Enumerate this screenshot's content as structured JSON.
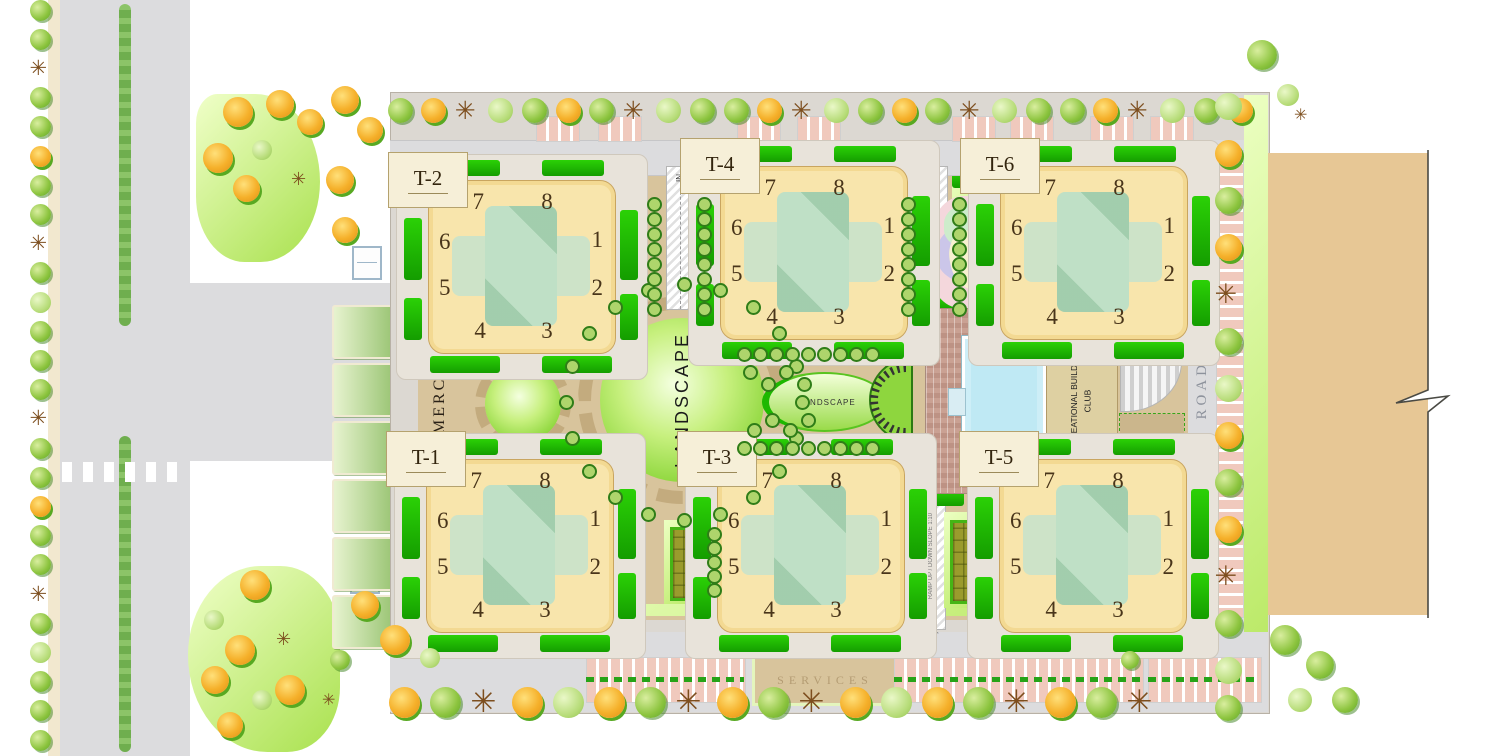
{
  "labels": {
    "road_top": "ROAD",
    "road_right": "ROAD",
    "commercial": "COMMERCIAL",
    "landscape_main": "LANDSCAPE",
    "landscape_small": "LANDSCAPE",
    "recreational_line1": "RECREATIONAL BUILDING /",
    "recreational_line2": "CLUB",
    "services": "SERVICES",
    "in_north_west": "IN",
    "in_north_east": "IN",
    "out_south": "OUT",
    "ramp_note": "RAMP UP / DOWN SLOPE 1:10"
  },
  "towers": [
    {
      "id": "t2",
      "label": "T-2",
      "units": [
        "7",
        "8",
        "6",
        "1",
        "5",
        "2",
        "4",
        "3"
      ]
    },
    {
      "id": "t4",
      "label": "T-4",
      "units": [
        "7",
        "8",
        "6",
        "1",
        "5",
        "2",
        "4",
        "3"
      ]
    },
    {
      "id": "t6",
      "label": "T-6",
      "units": [
        "7",
        "8",
        "6",
        "1",
        "5",
        "2",
        "4",
        "3"
      ]
    },
    {
      "id": "t1",
      "label": "T-1",
      "units": [
        "7",
        "8",
        "6",
        "1",
        "5",
        "2",
        "4",
        "3"
      ]
    },
    {
      "id": "t3",
      "label": "T-3",
      "units": [
        "7",
        "8",
        "6",
        "1",
        "5",
        "2",
        "4",
        "3"
      ]
    },
    {
      "id": "t5",
      "label": "T-5",
      "units": [
        "7",
        "8",
        "6",
        "1",
        "5",
        "2",
        "4",
        "3"
      ]
    }
  ],
  "colors": {
    "road_gray": "#dcdcde",
    "site_base": "#dcd8d2",
    "path_tan": "#d8c49c",
    "tower_cream": "#f8e5ac",
    "courtyard_teal": "#bfe0c6",
    "hedge_green": "#1db800",
    "lawn_light": "#c9ec83",
    "landscape_green": "#7fd02c",
    "tree_orange": "#f5b02a",
    "tree_green": "#8cc43e",
    "pool_blue": "#bfe9f4",
    "brick_paving": "#c69f91",
    "adjacent_building_tan": "#e7c795",
    "court_olive": "#9a9b2d",
    "parking_stall_pink": "#f0c9bd"
  }
}
